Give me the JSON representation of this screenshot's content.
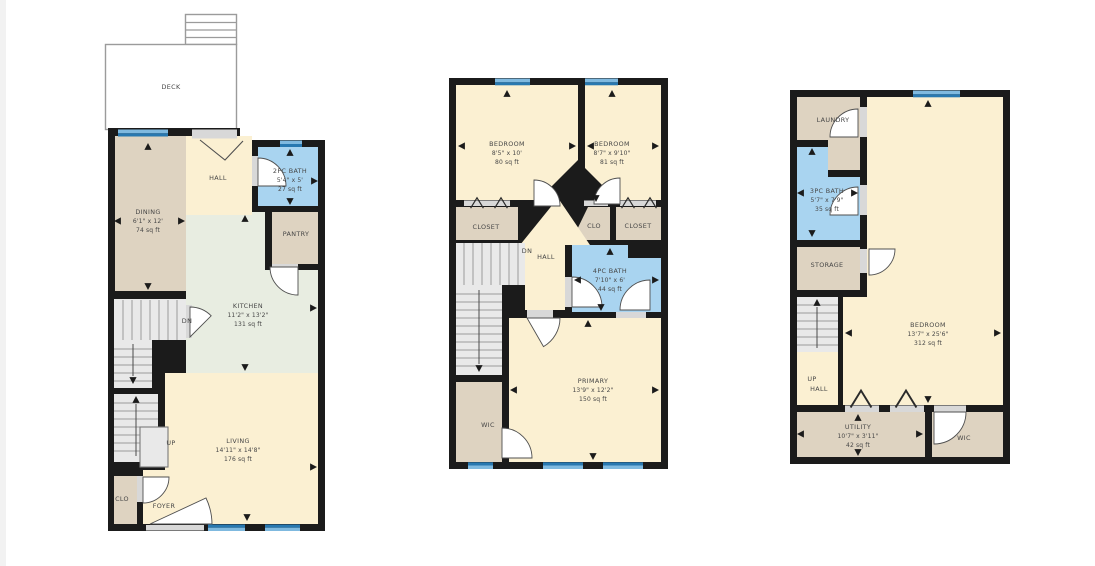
{
  "colors": {
    "wall": "#1b1b1b",
    "cream": "#FBF0D2",
    "tan": "#DED3C1",
    "bathblue": "#A9D4F0",
    "sage": "#E8EDE1",
    "stair": "#E9E9E9",
    "winLight": "#7FB9DF",
    "winDark": "#2878B0",
    "sill": "#D8D8D8",
    "deck": "#FFFFFF"
  },
  "plans": {
    "left": {
      "deck": {
        "name": "DECK"
      },
      "rooms": {
        "hall": {
          "name": "HALL"
        },
        "bath2pc": {
          "name": "2PC BATH",
          "dims": "5'4\" x 5'",
          "area": "27 sq ft"
        },
        "dining": {
          "name": "DINING",
          "dims": "6'1\" x 12'",
          "area": "74 sq ft"
        },
        "pantry": {
          "name": "PANTRY"
        },
        "kitchen": {
          "name": "KITCHEN",
          "dims": "11'2\" x 13'2\"",
          "area": "131 sq ft"
        },
        "living": {
          "name": "LIVING",
          "dims": "14'11\" x 14'8\"",
          "area": "176 sq ft"
        },
        "clo": {
          "name": "CLO"
        },
        "foyer": {
          "name": "FOYER"
        }
      },
      "stairs": {
        "up": "UP",
        "dn": "DN"
      }
    },
    "middle": {
      "rooms": {
        "bedroom1": {
          "name": "BEDROOM",
          "dims": "8'5\" x 10'",
          "area": "80 sq ft"
        },
        "bedroom2": {
          "name": "BEDROOM",
          "dims": "8'7\" x 9'10\"",
          "area": "81 sq ft"
        },
        "closet1": {
          "name": "CLOSET"
        },
        "clo": {
          "name": "CLO"
        },
        "closet2": {
          "name": "CLOSET"
        },
        "hall": {
          "name": "HALL"
        },
        "bath4pc": {
          "name": "4PC BATH",
          "dims": "7'10\" x 6'",
          "area": "44 sq ft"
        },
        "primary": {
          "name": "PRIMARY",
          "dims": "13'9\" x 12'2\"",
          "area": "150 sq ft"
        },
        "wic": {
          "name": "WIC"
        }
      },
      "stairs": {
        "dn": "DN"
      }
    },
    "right": {
      "rooms": {
        "laundry": {
          "name": "LAUNDRY"
        },
        "bath3pc": {
          "name": "3PC BATH",
          "dims": "5'7\" x 7'9\"",
          "area": "35 sq ft"
        },
        "storage": {
          "name": "STORAGE"
        },
        "bedroom": {
          "name": "BEDROOM",
          "dims": "13'7\" x 25'6\"",
          "area": "312 sq ft"
        },
        "hall": {
          "name": "HALL"
        },
        "utility": {
          "name": "UTILITY",
          "dims": "10'7\" x 3'11\"",
          "area": "42 sq ft"
        },
        "wic": {
          "name": "WIC"
        }
      },
      "stairs": {
        "up": "UP"
      }
    }
  }
}
